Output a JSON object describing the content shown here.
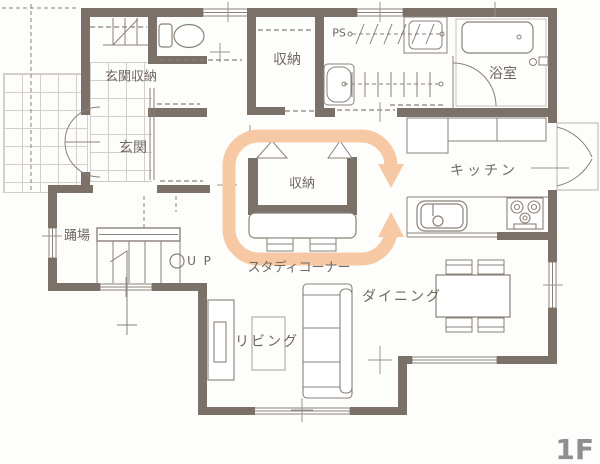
{
  "floor_label": "1F",
  "colors": {
    "wall": "#7b7169",
    "thin_line": "#8a8179",
    "circulation_arrow": "#f6c9a4",
    "label_text": "#6f6760",
    "floor_tag_text": "#8f8f8f"
  },
  "rooms": {
    "entrance_storage": "玄関収納",
    "upper_closet": "収納",
    "bathroom": "浴室",
    "entrance": "玄関",
    "stair_landing": "踊場",
    "center_closet": "収納",
    "study_corner": "スタディコーナー",
    "kitchen": "キッチン",
    "dining": "ダイニング",
    "living": "リビング"
  },
  "annotations": {
    "pipe_space": "PS",
    "stairs_up": "U P"
  }
}
